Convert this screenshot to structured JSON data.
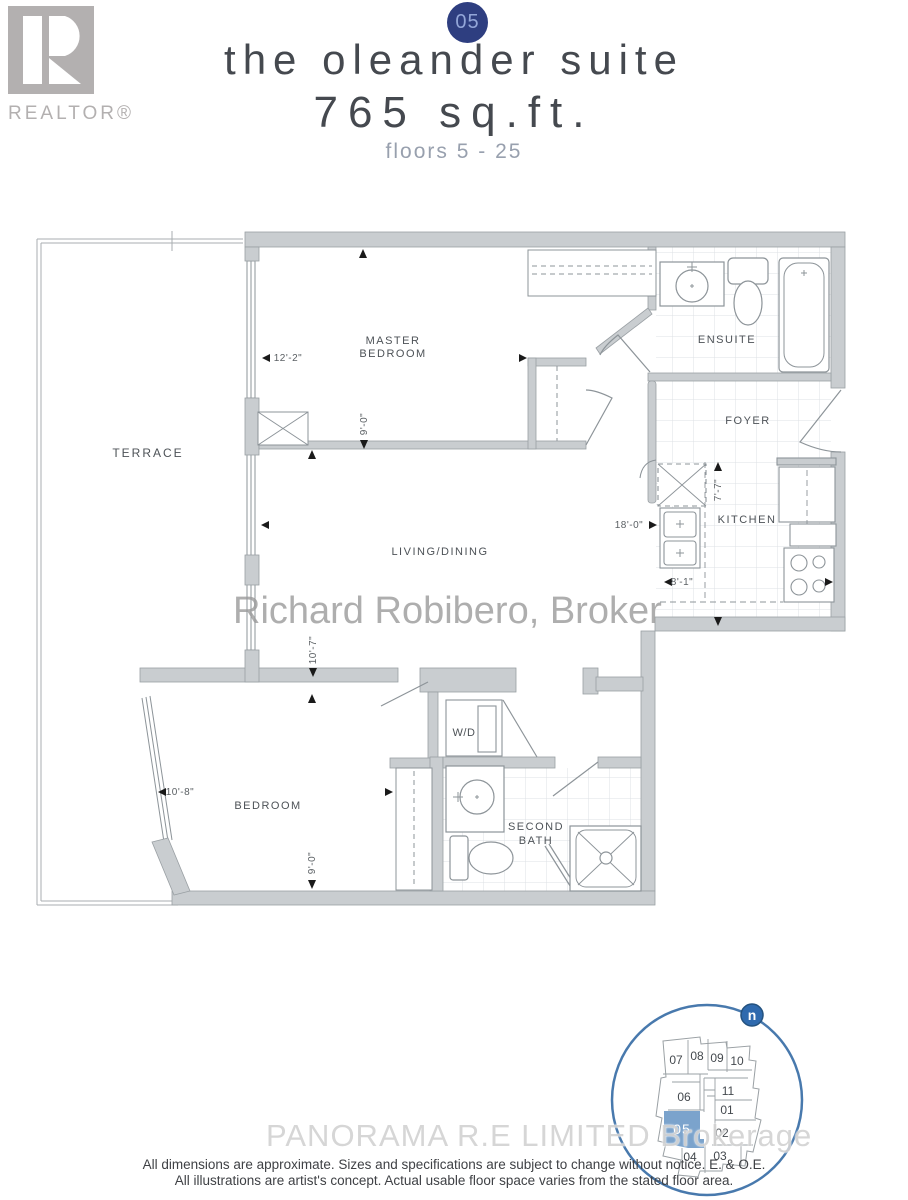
{
  "header": {
    "unit_badge": "05",
    "title": "the oleander suite",
    "area": "765 sq.ft.",
    "floors": "floors 5 - 25"
  },
  "logo": {
    "letter": "R",
    "label": "REALTOR®"
  },
  "plan": {
    "rooms": {
      "terrace": "TERRACE",
      "master_line1": "MASTER",
      "master_line2": "BEDROOM",
      "living": "LIVING/DINING",
      "ensuite": "ENSUITE",
      "foyer": "FOYER",
      "kitchen": "KITCHEN",
      "bedroom": "BEDROOM",
      "second_bath_line1": "SECOND",
      "second_bath_line2": "BATH",
      "wd": "W/D"
    },
    "dimensions": {
      "master_width": "12'-2\"",
      "master_depth": "9'-0\"",
      "living_depth": "10'-7\"",
      "living_width": "18'-0\"",
      "kitchen_width": "8'-1\"",
      "kitchen_depth": "7'-7\"",
      "bedroom_width": "10'-8\"",
      "bedroom_depth": "9'-0\""
    }
  },
  "watermarks": {
    "center": "Richard Robibero, Broker",
    "bottom": "PANORAMA R.E  LIMITED  Brokerage"
  },
  "keyplan": {
    "north": "n",
    "highlighted_unit": "05",
    "units": [
      {
        "id": "07"
      },
      {
        "id": "08"
      },
      {
        "id": "09"
      },
      {
        "id": "10"
      },
      {
        "id": "06"
      },
      {
        "id": "11"
      },
      {
        "id": "01"
      },
      {
        "id": "02"
      },
      {
        "id": "04"
      },
      {
        "id": "03"
      }
    ]
  },
  "disclaimer": {
    "line1": "All dimensions are approximate. Sizes and specifications are subject to change without notice. E. & O.E.",
    "line2": "All illustrations are artist's concept. Actual usable floor space varies from the stated floor area."
  },
  "colors": {
    "accent_navy": "#2e3e80",
    "keyplan_blue": "#7ba3cc",
    "north_blue": "#2f6aae",
    "wall_gray": "#c9cdd0"
  }
}
